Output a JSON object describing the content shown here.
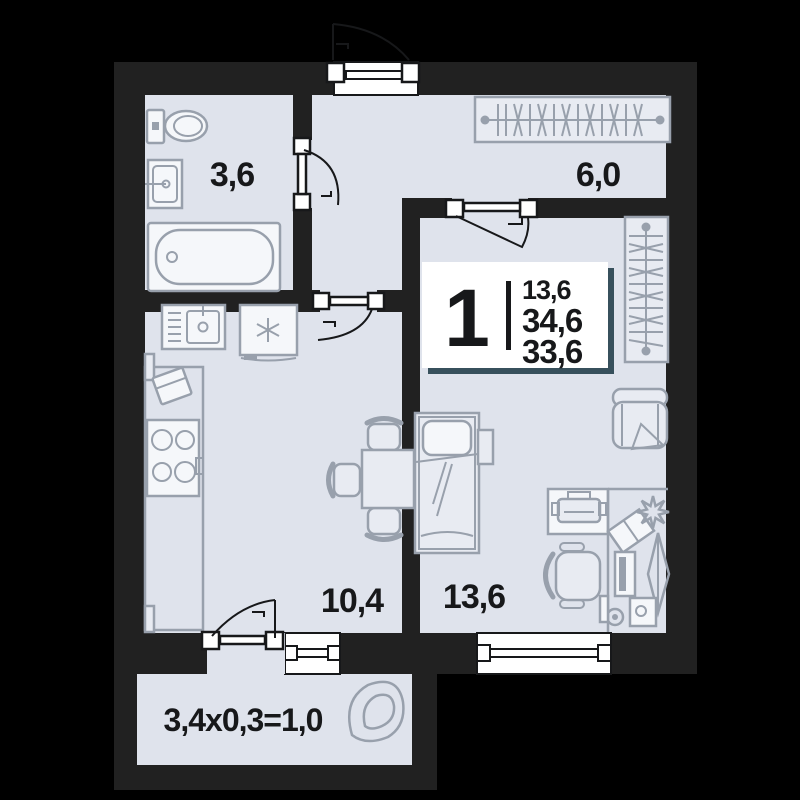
{
  "plan_title": "apartment-floor-plan",
  "unit": {
    "number": "1",
    "areas": {
      "living": "13,6",
      "total": "34,6",
      "other": "33,6"
    }
  },
  "rooms": {
    "bathroom": {
      "area": "3,6"
    },
    "hall": {
      "area": "6,0"
    },
    "kitchen": {
      "area": "10,4"
    },
    "bedroom": {
      "area": "13,6"
    },
    "balcony": {
      "label": "3,4x0,3=1,0"
    }
  },
  "colors": {
    "background": "#000000",
    "wall": "#212121",
    "floor": "#dfe3ec",
    "furniture_stroke": "#98a0ac",
    "text": "#17181a",
    "info_box_shadow": "#37505c",
    "window_fill": "#ffffff"
  }
}
